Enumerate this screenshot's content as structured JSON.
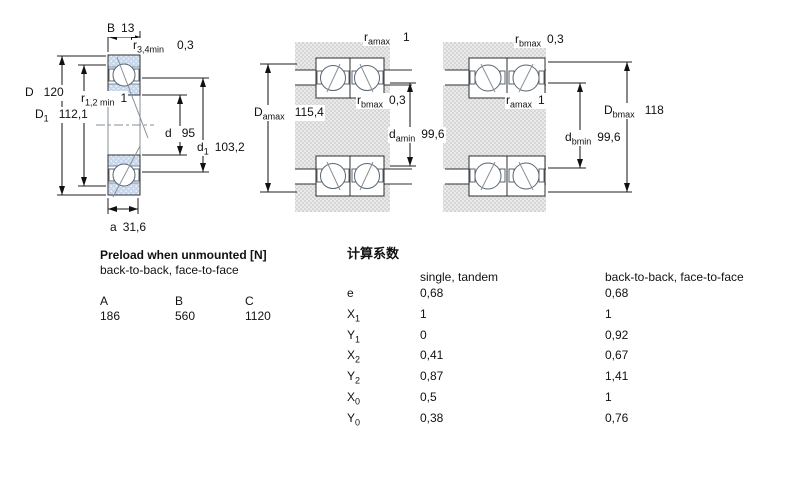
{
  "colors": {
    "bearing_ring_blue": "#c6d7ec",
    "housing_hatch_gray": "#d6d6d6",
    "line_black": "#111111"
  },
  "left_figure": {
    "B": {
      "base": "B",
      "sub": "",
      "value": "13"
    },
    "r34": {
      "base": "r",
      "sub": "3,4min",
      "value": "0,3"
    },
    "D": {
      "base": "D",
      "sub": "",
      "value": "120"
    },
    "D1": {
      "base": "D",
      "sub": "1",
      "value": "112,1"
    },
    "r12": {
      "base": "r",
      "sub": "1,2 min",
      "value": "1"
    },
    "d": {
      "base": "d",
      "sub": "",
      "value": "95"
    },
    "d1": {
      "base": "d",
      "sub": "1",
      "value": "103,2"
    },
    "a": {
      "base": "a",
      "sub": "",
      "value": "31,6"
    }
  },
  "middle_figure": {
    "ramax": {
      "base": "r",
      "sub": "amax",
      "value": "1"
    },
    "Damax": {
      "base": "D",
      "sub": "amax",
      "value": "115,4"
    },
    "rbmax": {
      "base": "r",
      "sub": "bmax",
      "value": "0,3"
    },
    "damin": {
      "base": "d",
      "sub": "amin",
      "value": "99,6"
    }
  },
  "right_figure": {
    "rbmax": {
      "base": "r",
      "sub": "bmax",
      "value": "0,3"
    },
    "ramax": {
      "base": "r",
      "sub": "amax",
      "value": "1"
    },
    "Dbmax": {
      "base": "D",
      "sub": "bmax",
      "value": "118"
    },
    "dbmin": {
      "base": "d",
      "sub": "bmin",
      "value": "99,6"
    }
  },
  "preload_table": {
    "title": "Preload when unmounted [N]",
    "subtitle": "back-to-back, face-to-face",
    "columns": [
      "A",
      "B",
      "C"
    ],
    "values": [
      "186",
      "560",
      "1120"
    ]
  },
  "factors_table": {
    "title": "计算系数",
    "col1_header": "single, tandem",
    "col2_header": "back-to-back, face-to-face",
    "rows": [
      {
        "base": "e",
        "sub": "",
        "v1": "0,68",
        "v2": "0,68"
      },
      {
        "base": "X",
        "sub": "1",
        "v1": "1",
        "v2": "1"
      },
      {
        "base": "Y",
        "sub": "1",
        "v1": "0",
        "v2": "0,92"
      },
      {
        "base": "X",
        "sub": "2",
        "v1": "0,41",
        "v2": "0,67"
      },
      {
        "base": "Y",
        "sub": "2",
        "v1": "0,87",
        "v2": "1,41"
      },
      {
        "base": "X",
        "sub": "0",
        "v1": "0,5",
        "v2": "1"
      },
      {
        "base": "Y",
        "sub": "0",
        "v1": "0,38",
        "v2": "0,76"
      }
    ]
  }
}
